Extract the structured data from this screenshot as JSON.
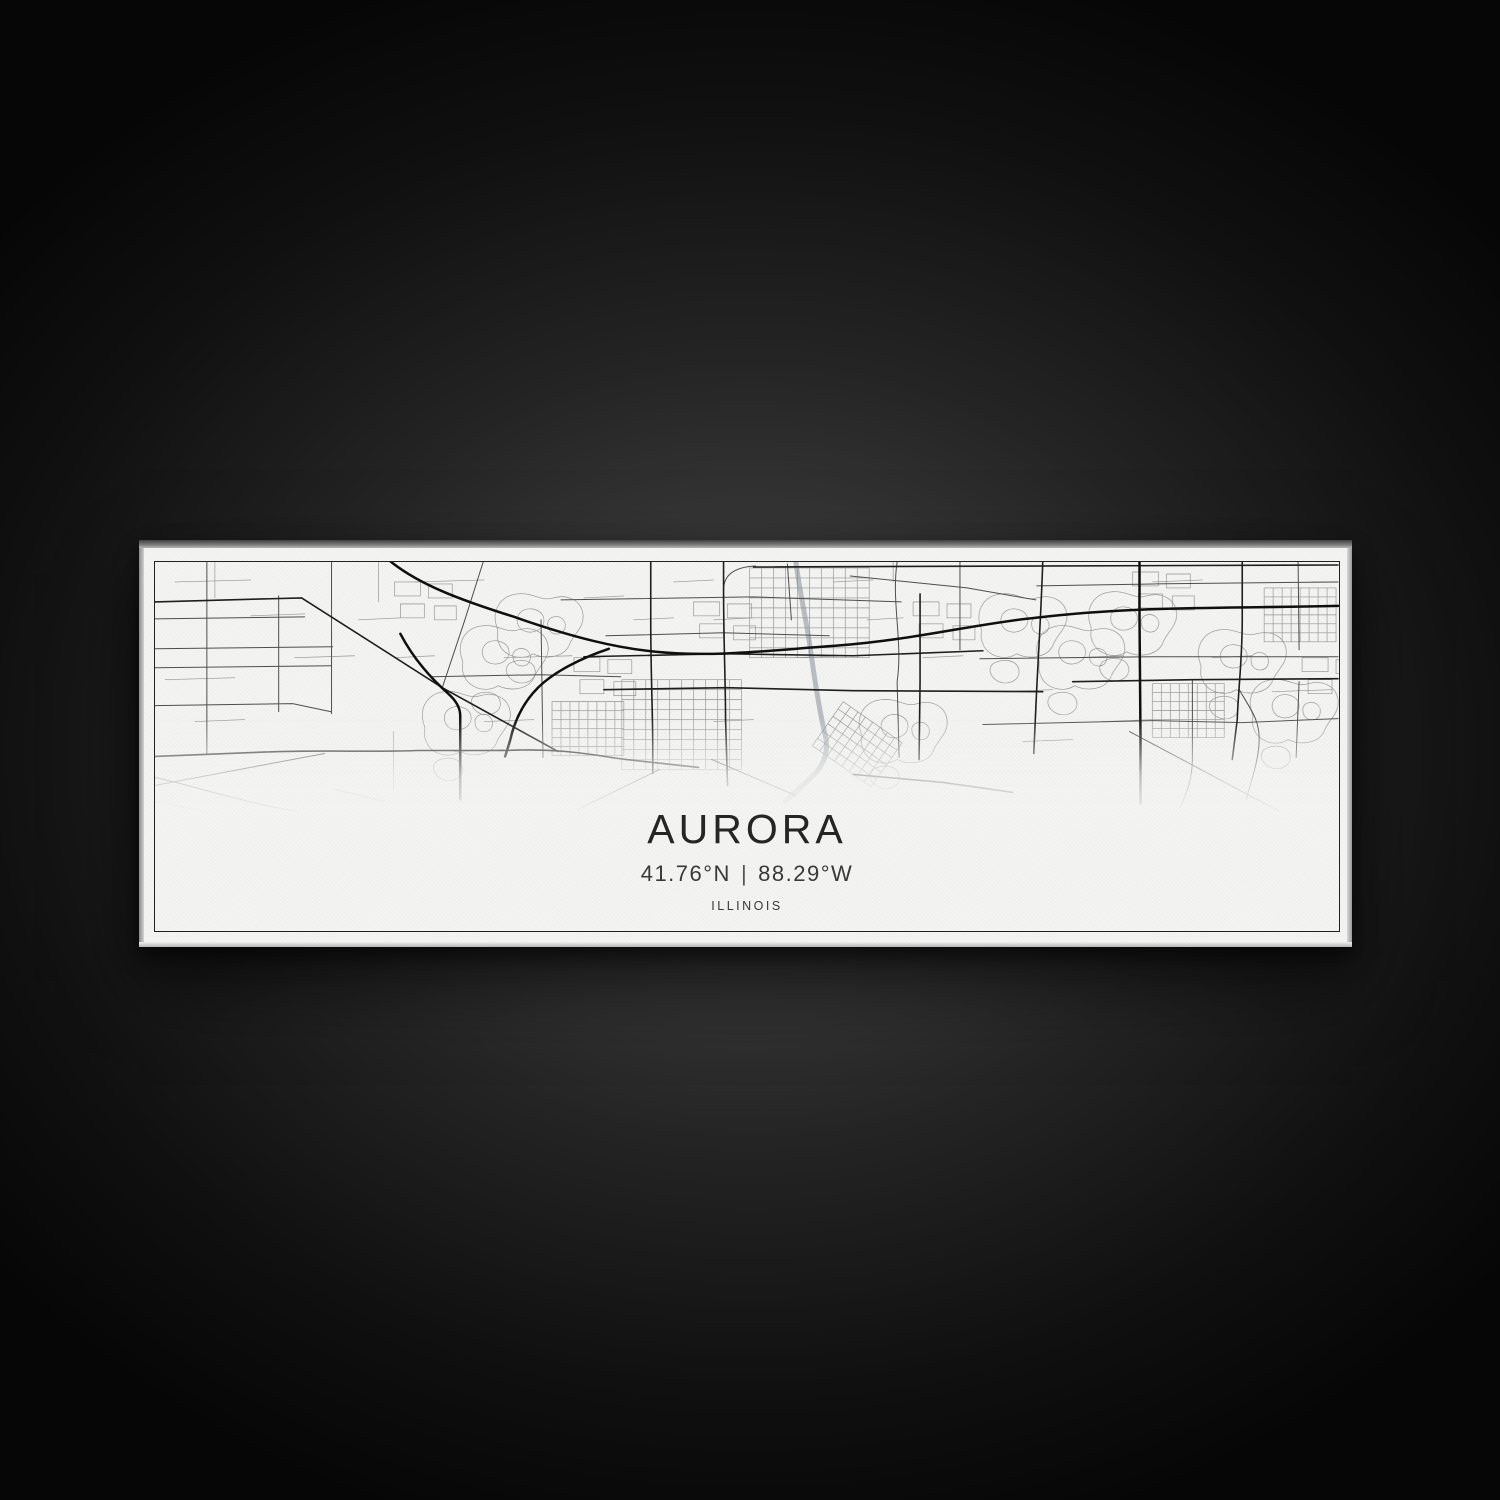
{
  "artwork": {
    "title": "AURORA",
    "latitude": "41.76°N",
    "separator": "|",
    "longitude": "88.29°W",
    "coordinates": "41.76°N | 88.29°W",
    "region": "ILLINOIS"
  },
  "colors": {
    "background_glow": "#4e4e4e",
    "background_dark": "#060606",
    "canvas_white": "#f4f4f3",
    "map_ink": "#1a1a1a",
    "river_gray": "#b9bec4"
  },
  "map": {
    "viewbox": "0 0 1187 370",
    "defs": {
      "gridA": "M0,0L0,90M12,0L12,90M24,0L24,90M36,0L36,90M48,0L48,90M60,0L60,90M72,0L72,90M84,0L84,90M96,0L96,90M108,0L108,90M120,0L120,90M0,0L120,0M0,10L120,10M0,20L120,20M0,30L120,30M0,40L120,40M0,50L120,50M0,60L120,60M0,70L120,70M0,80L120,80M0,90L120,90",
      "gridB": "M0,0L0,54M9,0L9,54M18,0L18,54M27,0L27,54M36,0L36,54M45,0L45,54M54,0L54,54M63,0L63,54M72,0L72,54M0,0L72,0M0,9L72,9M0,18L72,18M0,27L72,27M0,36L72,36M0,45L72,45M0,54L72,54",
      "loops": "M8,40C2,24 10,8 28,6C44,4 52,14 64,10C78,6 92,12 94,26C96,40 84,46 80,58C74,70 56,72 44,66C32,74 14,68 10,56C6,48 10,44 8,40M30,26C36,18 50,20 54,28C58,38 48,46 38,44C28,42 26,32 30,26M62,30C70,26 78,32 76,40C74,48 64,48 60,42C58,36 58,33 62,30M20,76C30,70 44,72 46,82C48,92 36,98 26,94C18,90 14,82 20,76",
      "blocks": "M0,0L26,0L26,14L0,14ZM34,2L58,2L58,16L34,16ZM6,22L30,22L30,36L6,36ZM40,24L62,24L62,38L40,38Z"
    },
    "layers": [
      {
        "name": "river",
        "color": "#b9bec4",
        "width": 5,
        "paths": [
          "M642,-4C646,30 654,62 658,94C662,124 668,158 672,174C676,190 670,204 660,214C650,224 640,232 632,240"
        ]
      },
      {
        "name": "minor-roads",
        "color": "#8f8f8f",
        "width": 0.65,
        "opacity": 0.95,
        "paths": [
          {
            "ref": "loops",
            "t": [
              820,
              26
            ]
          },
          {
            "ref": "loops",
            "t": [
              878,
              58
            ]
          },
          {
            "ref": "loops",
            "t": [
              930,
              24
            ]
          },
          {
            "ref": "loops",
            "t": [
              1040,
              62
            ]
          },
          {
            "ref": "loops",
            "t": [
              1092,
              112
            ]
          },
          {
            "ref": "loops",
            "t": [
              300,
              58
            ]
          },
          {
            "ref": "loops",
            "t": [
              262,
              124
            ]
          },
          {
            "ref": "loops",
            "t": [
              335,
              26
            ]
          },
          {
            "ref": "loops",
            "t": [
              700,
              132
            ]
          },
          {
            "ref": "gridA",
            "t": [
              468,
              118
            ]
          },
          {
            "ref": "gridA",
            "t": [
              596,
              6
            ]
          },
          {
            "ref": "gridB",
            "t": [
              1112,
              26
            ]
          },
          {
            "ref": "gridB",
            "t": [
              1000,
              122
            ]
          },
          {
            "ref": "gridB",
            "t": [
              398,
              140
            ]
          },
          {
            "ref": "gridB",
            "t": [
              690,
              140
            ],
            "r": 35
          },
          {
            "ref": "blocks",
            "t": [
              240,
              20
            ]
          },
          {
            "ref": "blocks",
            "t": [
              540,
              40
            ]
          },
          {
            "ref": "blocks",
            "t": [
              760,
              40
            ]
          },
          {
            "ref": "blocks",
            "t": [
              980,
              10
            ]
          },
          {
            "ref": "blocks",
            "t": [
              1150,
              96
            ]
          },
          {
            "ref": "blocks",
            "t": [
              420,
              96
            ]
          },
          "M20,20L96,18M60,0L60,36M96,54L150,52M10,118L80,116M204,58L246,56M224,0L224,40M140,96L200,94M260,20L330,18M350,96L418,94M430,36L470,34M520,20L560,18M560,58L600,56M640,96L690,94M714,58L750,56M770,96L810,94M850,130L900,128M920,96L970,94M1000,20L1050,18M1060,96L1100,94M1120,130L1180,128M950,160L1000,158M870,180L920,178M330,160L380,158M300,190L350,188M560,160L600,158M240,96L280,94M480,58L520,56M680,20L720,18M740,0L740,20M1160,20L1186,20M40,160L90,158M0,240L60,252M180,228L230,240M239,170L239,228"
        ]
      },
      {
        "name": "secondary-roads",
        "color": "#4f4f4f",
        "width": 1,
        "paths": [
          "M0,57L150,55",
          "M0,87L178,85",
          "M0,106L177,104",
          "M0,144L138,142L176,150",
          "M52,0L52,192",
          "M124,34L124,150",
          "M177,0L177,152",
          "M329,0L310,60L288,126",
          "M387,58L389,196",
          "M407,38L600,35L748,40",
          "M452,74L570,71L676,74",
          "M634,2L638,58",
          "M744,0C738,40 750,80 744,120L746,196",
          "M807,0L807,88",
          "M827,97L1000,95L1186,95",
          "M830,163L1000,159L1090,161L1186,157",
          "M1146,0L1147,88M1147,120L1144,196",
          "M977,170L1127,250",
          "M697,14L814,26L883,38",
          "M558,198L642,234",
          "M506,208L424,248",
          "M277,115L387,113L467,115",
          "M1040,118L1040,198C1040,218 1034,232 1028,246",
          "M1087,128C1097,146 1107,157 1107,177C1107,197 1100,216 1094,238",
          "M570,28C570,12 582,5 602,4",
          "M884,24L1000,22L1186,20",
          "M0,216C44,226 92,242 142,250",
          "M0,224L170,192"
        ]
      },
      {
        "name": "major-roads",
        "color": "#1f1f1f",
        "width": 1.6,
        "paths": [
          "M0,195L100,191C160,188 220,191 262,189L352,189C410,186 446,195 472,198L545,206",
          "M700,213L790,221L860,231",
          "M0,40L147,36L288,126L404,190",
          "M570,0L570,28C570,80 572,120 572,158L574,224",
          "M497,0L497,60C497,110 499,150 499,186L499,212",
          "M767,32L767,120L766,198",
          "M890,0C888,60 885,100 883,148L881,192",
          "M450,128L572,126L700,129L890,130",
          "M430,95L570,92L700,94L830,89",
          "M1090,0L1090,58C1090,98 1086,128 1085,158L1080,198",
          "M920,120L1040,118L1186,117",
          "M600,5L1186,3"
        ]
      },
      {
        "name": "highways",
        "color": "#101010",
        "width": 2.5,
        "paths": [
          "M232,-4C262,22 306,38 360,55C420,76 462,86 502,90C562,96 622,88 682,84C762,78 822,62 882,56C982,44 1062,47 1186,44",
          "M246,72C258,95 276,116 294,132C303,140 306,147 306,154L306,238",
          "M455,87C428,96 400,110 384,126C368,142 360,161 356,179L351,195",
          "M987,0L987,56C987,100 988,140 988,176L988,242"
        ]
      }
    ]
  }
}
